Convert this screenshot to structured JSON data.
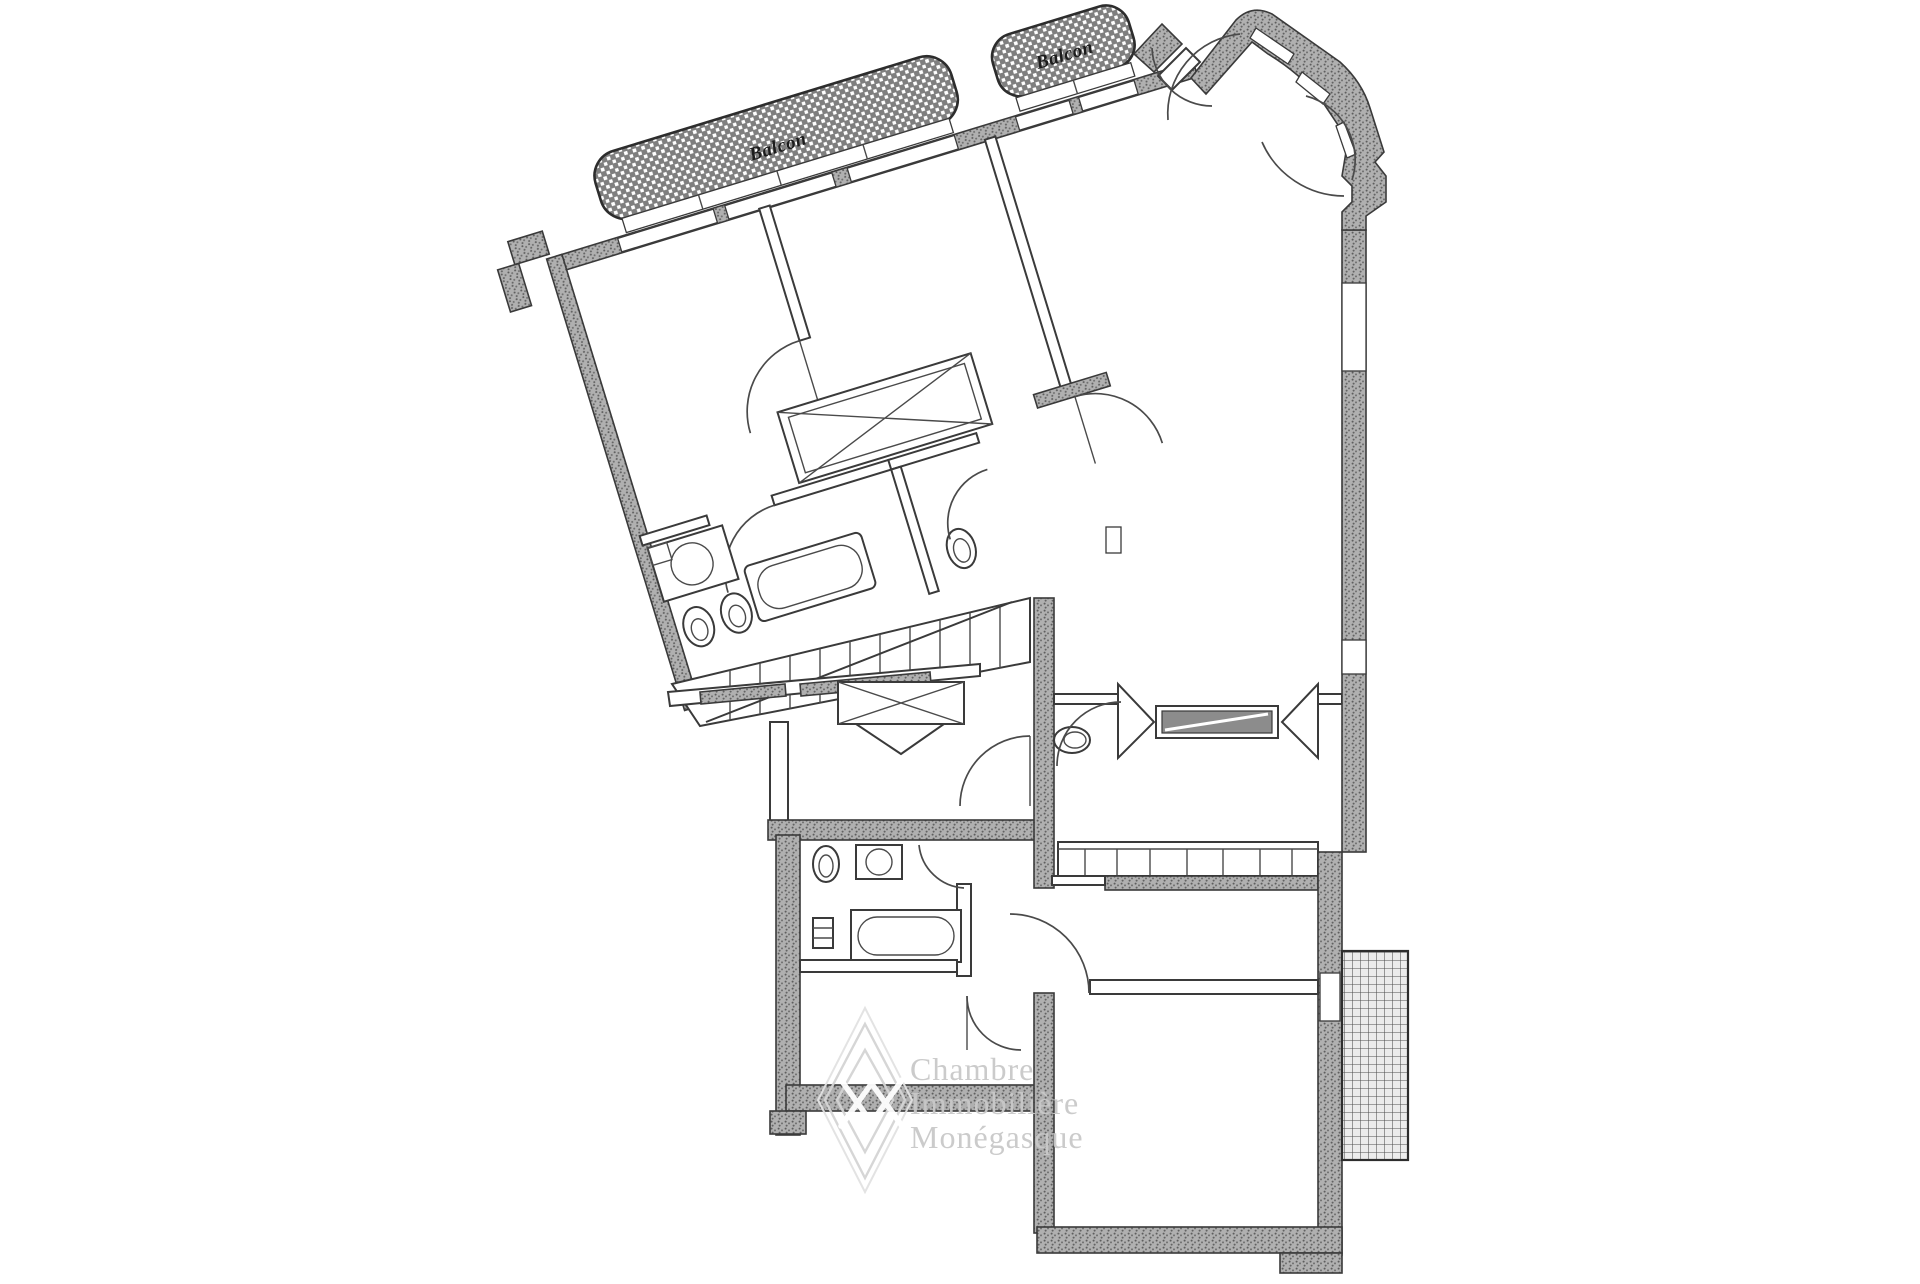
{
  "labels": {
    "balcony_left": "Balcon",
    "balcony_right": "Balcon"
  },
  "watermark": {
    "lines": [
      "Chambre",
      "Immobilière",
      "Monégasque"
    ],
    "logo": "double-diamond-icon"
  },
  "palette": {
    "paper": "#ffffff",
    "ink": "#3a3a3a",
    "wall_gray": "#b0b0b0",
    "wall_dot": "#5e5e5e",
    "balcony_gray": "#7f7f7f",
    "watermark_gray": "#c9c9c9"
  }
}
